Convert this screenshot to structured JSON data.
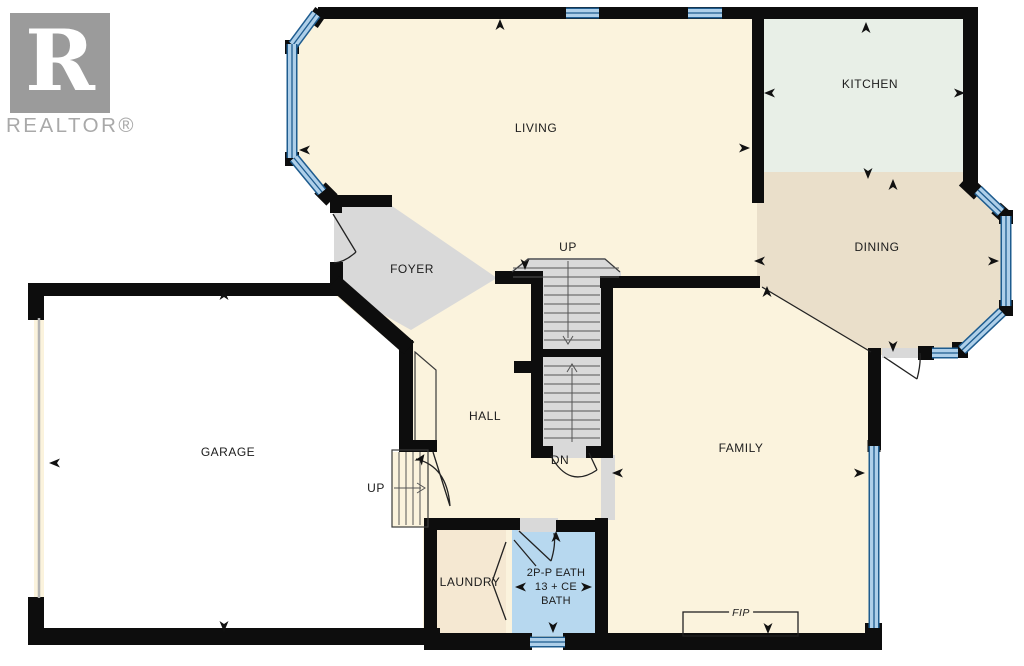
{
  "branding": {
    "logo_letter": "R",
    "logo_text": "REALTOR®"
  },
  "rooms": {
    "living": "LIVING",
    "kitchen": "KITCHEN",
    "dining": "DINING",
    "foyer": "FOYER",
    "hall": "HALL",
    "family": "FAMILY",
    "garage": "GARAGE",
    "laundry": "LAUNDRY",
    "bath_line1": "2P-P EATH",
    "bath_line2": "13 + CE",
    "bath_line3": "BATH"
  },
  "stairs": {
    "up_main": "UP",
    "down_main": "DN",
    "up_garage": "UP"
  },
  "fireplace_label": "FIP",
  "colors": {
    "wall": "#0d0d0d",
    "cream": "#fbf3dd",
    "kitchen": "#e8efe7",
    "dining": "#eadfca",
    "laundry": "#f5e8d2",
    "bath": "#b7d8ef",
    "gray": "#d9d9d9",
    "white": "#ffffff",
    "window_light": "#aecfe9",
    "window_dark": "#1e5c8f",
    "logo_gray": "#9b9b9b"
  }
}
